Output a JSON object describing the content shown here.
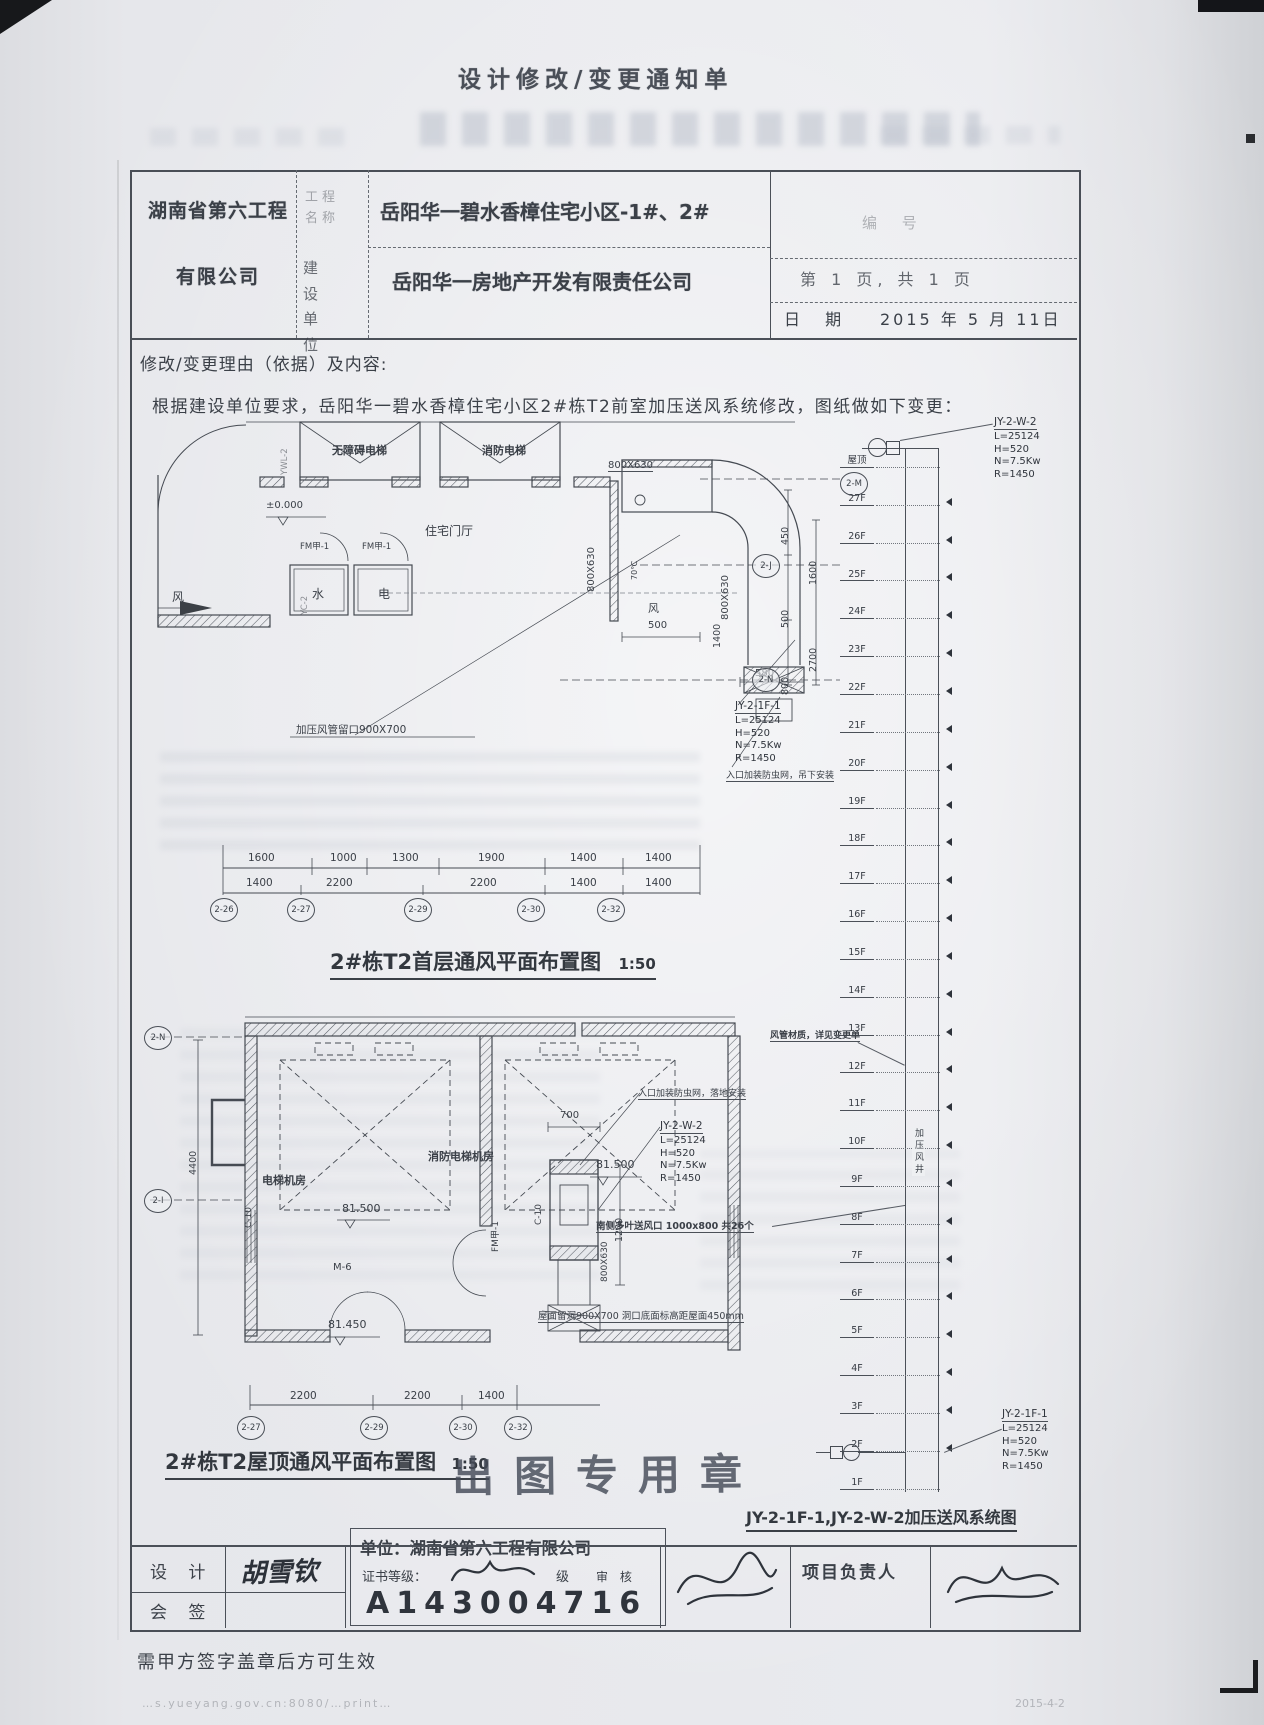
{
  "page": {
    "title": "设计修改/变更通知单",
    "note": "需甲方签字盖章后方可生效",
    "footer_url": "…s.yueyang.gov.cn:8080/…print…",
    "footer_date": "2015-4-2"
  },
  "header": {
    "company_line1": "湖南省第六工程",
    "company_line2": "有限公司",
    "project_label": "工程名称",
    "project_name": "岳阳华一碧水香樟住宅小区-1#、2#",
    "builder_label": "建设单位",
    "builder_name": "岳阳华一房地产开发有限责任公司",
    "serial_label": "编 号",
    "page_info": "第 1 页, 共 1 页",
    "date_label": "日 期",
    "date_value": "2015 年 5 月 11日"
  },
  "reason": {
    "label": "修改/变更理由（依据）及内容:",
    "text": "根据建设单位要求，岳阳华一碧水香樟住宅小区2#栋T2前室加压送风系统修改，图纸做如下变更："
  },
  "plan1": {
    "caption": "2#栋T2首层通风平面布置图",
    "scale": "1:50",
    "elevator_a": "无障碍电梯",
    "elevator_b": "消防电梯",
    "lobby": "住宅门厅",
    "level": "±0.000",
    "door_a": "FM甲-1",
    "door_b": "FM甲-1",
    "room_water": "水",
    "room_elec": "电",
    "wind_a": "风",
    "wind_b": "风",
    "temp": "70℃",
    "duct_a": "800X630",
    "duct_b": "800X630",
    "duct_c": "800X630",
    "dim_500": "500",
    "dim_580": "580",
    "d450": "450",
    "d500": "500",
    "d800": "800",
    "d1600": "1600",
    "d2700": "2700",
    "d1400": "1400",
    "hole_callout": "加压风管留口900X700",
    "fan_id": "JY-2-1F-1",
    "fan_l": "L=25124",
    "fan_h": "H=520",
    "fan_n": "N=7.5Kw",
    "fan_r": "R=1450",
    "inlet_note": "入口加装防虫网，吊下安装",
    "riser_code_a": "YWL-2",
    "riser_code_b": "YC-2",
    "dims_row1": [
      "1600",
      "1000",
      "1300",
      "1900",
      "1400",
      "1400"
    ],
    "dims_row2": [
      "1400",
      "2200",
      "2200",
      "1400",
      "1400"
    ],
    "bubbles_bottom": [
      "2-26",
      "2-27",
      "2-29",
      "2-30",
      "2-32"
    ],
    "bubbles_right": [
      "2-M",
      "2-J",
      "2-N"
    ]
  },
  "plan2": {
    "caption": "2#栋T2屋顶通风平面布置图",
    "scale": "1:50",
    "machine_room": "电梯机房",
    "fire_machine_room": "消防电梯机房",
    "level_a": "81.500",
    "level_b": "81.500",
    "level_c": "81.450",
    "door_m6": "M-6",
    "door_fm": "FM甲-1",
    "window_a": "C-10",
    "window_b": "C-10",
    "dim_4400": "4400",
    "dim_700": "700",
    "dim_1200": "1200",
    "duct": "800X630",
    "fan_id": "JY-2-W-2",
    "fan_l": "L=25124",
    "fan_h": "H=520",
    "fan_n": "N=7.5Kw",
    "fan_r": "R=1450",
    "inlet_note": "入口加装防虫网，落地安装",
    "louver_callout": "南侧多叶送风口 1000x800 共26个",
    "roof_hole_callout": "屋面留洞900X700 洞口底面标高距屋面450mm",
    "dims_bottom": [
      "2200",
      "2200",
      "1400"
    ],
    "bubbles_bottom": [
      "2-27",
      "2-29",
      "2-30",
      "2-32"
    ],
    "bubbles_left": [
      "2-N",
      "2-I"
    ]
  },
  "riser": {
    "caption": "JY-2-1F-1,JY-2-W-2加压送风系统图",
    "shaft_label": "加压风井",
    "material_note": "风管材质，详见变更单",
    "top": {
      "id": "JY-2-W-2",
      "l": "L=25124",
      "h": "H=520",
      "n": "N=7.5Kw",
      "r": "R=1450"
    },
    "bottom": {
      "id": "JY-2-1F-1",
      "l": "L=25124",
      "h": "H=520",
      "n": "N=7.5Kw",
      "r": "R=1450"
    },
    "floors": [
      "屋顶",
      "27F",
      "26F",
      "25F",
      "24F",
      "23F",
      "22F",
      "21F",
      "20F",
      "19F",
      "18F",
      "17F",
      "16F",
      "15F",
      "14F",
      "13F",
      "12F",
      "11F",
      "10F",
      "9F",
      "8F",
      "7F",
      "6F",
      "5F",
      "4F",
      "3F",
      "2F",
      "1F"
    ]
  },
  "stamp": {
    "big": "出图专用章",
    "unit": "单位：湖南省第六工程有限公司",
    "cert_label": "证书等级：",
    "cert_suffix": "级",
    "reg_number": "A143004716"
  },
  "signoff": {
    "design_label": "设 计",
    "design_name": "胡雪钦",
    "cosign_label": "会 签",
    "review_label": "审 核",
    "lead_label": "项目负责人"
  }
}
